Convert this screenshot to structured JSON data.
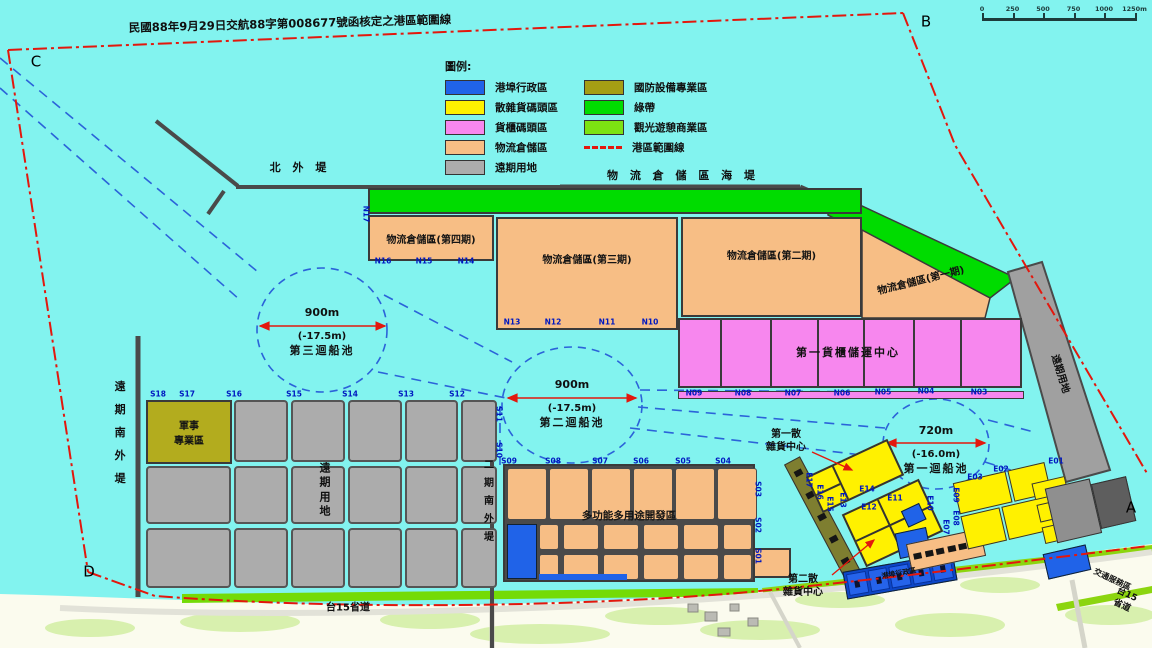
{
  "title": "民國88年9月29日交航88字第008677號函核定之港區範圍線",
  "scale_bar": {
    "ticks": [
      "0",
      "250",
      "500",
      "750",
      "1000",
      "1250m"
    ]
  },
  "legend": {
    "title": "圖例:",
    "left": [
      {
        "label": "港埠行政區",
        "color": "#2063E8",
        "swatch": "fill"
      },
      {
        "label": "散雜貨碼頭區",
        "color": "#FFF100",
        "swatch": "fill"
      },
      {
        "label": "貨櫃碼頭區",
        "color": "#F787EE",
        "swatch": "fill"
      },
      {
        "label": "物流倉儲區",
        "color": "#F7BE85",
        "swatch": "fill"
      },
      {
        "label": "遠期用地",
        "color": "#ACACAC",
        "swatch": "fill"
      }
    ],
    "right": [
      {
        "label": "國防設備專業區",
        "color": "#A59E14",
        "swatch": "fill"
      },
      {
        "label": "綠帶",
        "color": "#00DC00",
        "swatch": "fill"
      },
      {
        "label": "觀光遊憩商業區",
        "color": "#7CE212",
        "swatch": "fill"
      },
      {
        "label": "港區範圍線",
        "color": "#E3170D",
        "swatch": "dash"
      }
    ]
  },
  "zones": {
    "phase4": "物流倉儲區(第四期)",
    "phase3": "物流倉儲區(第三期)",
    "phase2": "物流倉儲區(第二期)",
    "military": "軍事\n專業區",
    "longterm": "遠期用地",
    "multipurpose": "多功能多用途開發區"
  },
  "basins": [
    {
      "diameter": "900m",
      "depth": "(-17.5m)",
      "name": "第三迴船池"
    },
    {
      "diameter": "900m",
      "depth": "(-17.5m)",
      "name": "第二迴船池"
    },
    {
      "diameter": "720m",
      "depth": "(-16.0m)",
      "name": "第一迴船池"
    }
  ],
  "floating_labels": [
    {
      "t": "北 外 堤",
      "x": 300,
      "y": 168,
      "fs": 11,
      "ls": 4,
      "cls": "north-breakwater-label"
    },
    {
      "t": "物 流 倉 儲 區 海 堤",
      "x": 683,
      "y": 176,
      "fs": 11,
      "ls": 4,
      "cls": "logistics-seawall-label"
    },
    {
      "t": "遠期南外堤",
      "x": 119,
      "y": 438,
      "fs": 11,
      "v": 1,
      "ls": 12,
      "cls": "longterm-south-breakwater-label"
    },
    {
      "t": "二期南外堤",
      "x": 487,
      "y": 504,
      "fs": 10,
      "v": 1,
      "ls": 8,
      "cls": "phase2-south-breakwater-label"
    },
    {
      "t": "物流倉儲區(第一期)",
      "x": 921,
      "y": 281,
      "fs": 10,
      "rot": -14,
      "cls": "phase1-label"
    },
    {
      "t": "第一貨櫃儲運中心",
      "x": 848,
      "y": 353,
      "fs": 11,
      "ls": 2,
      "cls": "container-center-label"
    },
    {
      "t": "第一散\n雜貨中心",
      "x": 786,
      "y": 441,
      "fs": 10,
      "cls": "bulk-cargo-center-1-label"
    },
    {
      "t": "第二散\n雜貨中心",
      "x": 803,
      "y": 586,
      "fs": 10,
      "cls": "bulk-cargo-center-2-label"
    },
    {
      "t": "台15省道",
      "x": 348,
      "y": 608,
      "fs": 10,
      "cls": "highway-15-label"
    },
    {
      "t": "台15省道",
      "x": 1124,
      "y": 601,
      "fs": 9,
      "rot": 25,
      "cls": "highway-15-label-right"
    },
    {
      "t": "交通服務區",
      "x": 1112,
      "y": 580,
      "fs": 8,
      "rot": 25,
      "cls": "traffic-service-area-label"
    },
    {
      "t": "港埠行政區",
      "x": 899,
      "y": 574,
      "fs": 7,
      "rot": -10,
      "cls": "port-admin-label"
    },
    {
      "t": "遠期用地",
      "x": 1060,
      "y": 374,
      "fs": 10,
      "rot": 73,
      "cls": "longterm-east-label"
    },
    {
      "t": "C",
      "x": 36,
      "y": 62,
      "fs": 15,
      "cls": "corner-label"
    },
    {
      "t": "B",
      "x": 926,
      "y": 22,
      "fs": 15,
      "cls": "corner-label"
    },
    {
      "t": "A",
      "x": 1131,
      "y": 508,
      "fs": 15,
      "cls": "corner-label"
    },
    {
      "t": "D",
      "x": 89,
      "y": 572,
      "fs": 15,
      "cls": "corner-label"
    }
  ],
  "berths": [
    {
      "t": "N17",
      "x": 366,
      "y": 214,
      "v": 1
    },
    {
      "t": "N16",
      "x": 383,
      "y": 261
    },
    {
      "t": "N15",
      "x": 424,
      "y": 261
    },
    {
      "t": "N14",
      "x": 466,
      "y": 261
    },
    {
      "t": "N13",
      "x": 512,
      "y": 322
    },
    {
      "t": "N12",
      "x": 553,
      "y": 322
    },
    {
      "t": "N11",
      "x": 607,
      "y": 322
    },
    {
      "t": "N10",
      "x": 650,
      "y": 322
    },
    {
      "t": "N09",
      "x": 694,
      "y": 393
    },
    {
      "t": "N08",
      "x": 743,
      "y": 393
    },
    {
      "t": "N07",
      "x": 793,
      "y": 393
    },
    {
      "t": "N06",
      "x": 842,
      "y": 393
    },
    {
      "t": "N05",
      "x": 883,
      "y": 392
    },
    {
      "t": "N04",
      "x": 926,
      "y": 391
    },
    {
      "t": "N03",
      "x": 979,
      "y": 392
    },
    {
      "t": "S18",
      "x": 158,
      "y": 394
    },
    {
      "t": "S17",
      "x": 187,
      "y": 394
    },
    {
      "t": "S16",
      "x": 234,
      "y": 394
    },
    {
      "t": "S15",
      "x": 294,
      "y": 394
    },
    {
      "t": "S14",
      "x": 350,
      "y": 394
    },
    {
      "t": "S13",
      "x": 406,
      "y": 394
    },
    {
      "t": "S12",
      "x": 457,
      "y": 394
    },
    {
      "t": "S11",
      "x": 499,
      "y": 414,
      "v": 1
    },
    {
      "t": "S10",
      "x": 499,
      "y": 450,
      "v": 1
    },
    {
      "t": "S09",
      "x": 509,
      "y": 461
    },
    {
      "t": "S08",
      "x": 553,
      "y": 461
    },
    {
      "t": "S07",
      "x": 600,
      "y": 461
    },
    {
      "t": "S06",
      "x": 641,
      "y": 461
    },
    {
      "t": "S05",
      "x": 683,
      "y": 461
    },
    {
      "t": "S04",
      "x": 723,
      "y": 461
    },
    {
      "t": "S03",
      "x": 758,
      "y": 489,
      "v": 1
    },
    {
      "t": "S02",
      "x": 758,
      "y": 525,
      "v": 1
    },
    {
      "t": "S01",
      "x": 758,
      "y": 556,
      "v": 1
    },
    {
      "t": "E17",
      "x": 809,
      "y": 480,
      "v": 1
    },
    {
      "t": "E16",
      "x": 820,
      "y": 492,
      "v": 1
    },
    {
      "t": "E15",
      "x": 830,
      "y": 504,
      "v": 1
    },
    {
      "t": "E14",
      "x": 867,
      "y": 489
    },
    {
      "t": "E13",
      "x": 843,
      "y": 500,
      "v": 1
    },
    {
      "t": "E12",
      "x": 869,
      "y": 507
    },
    {
      "t": "E11",
      "x": 895,
      "y": 498
    },
    {
      "t": "E10",
      "x": 930,
      "y": 503,
      "v": 1
    },
    {
      "t": "E09",
      "x": 956,
      "y": 495,
      "v": 1
    },
    {
      "t": "E08",
      "x": 956,
      "y": 518,
      "v": 1
    },
    {
      "t": "E07",
      "x": 946,
      "y": 527,
      "v": 1
    },
    {
      "t": "E03",
      "x": 975,
      "y": 477
    },
    {
      "t": "E02",
      "x": 1001,
      "y": 469
    },
    {
      "t": "E01",
      "x": 1056,
      "y": 461
    }
  ]
}
